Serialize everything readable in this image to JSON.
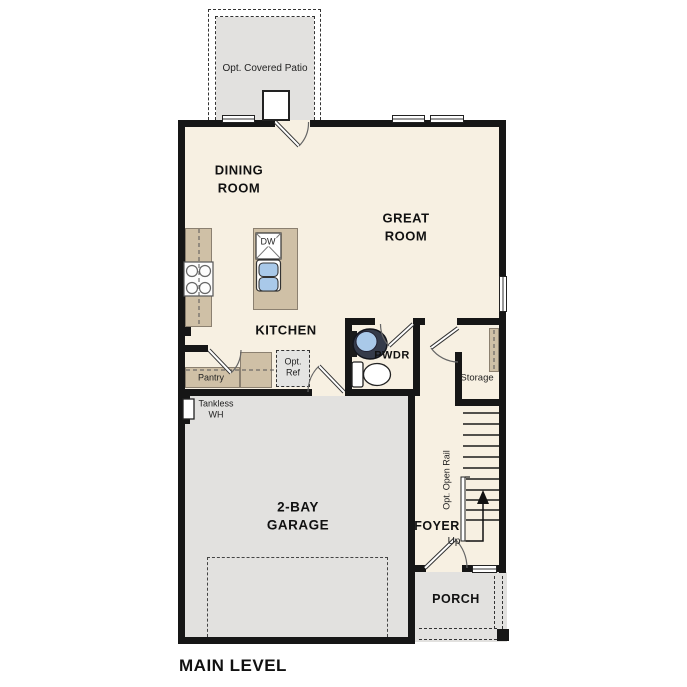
{
  "plan_title": "MAIN LEVEL",
  "labels": {
    "patio": "Opt. Covered Patio",
    "dining": [
      "DINING",
      "ROOM"
    ],
    "great": [
      "GREAT",
      "ROOM"
    ],
    "kitchen": "KITCHEN",
    "dishwasher": "DW",
    "powder": "PWDR",
    "pantry": "Pantry",
    "opt_ref": [
      "Opt.",
      "Ref"
    ],
    "storage": "Storage",
    "tankless": [
      "Tankless",
      "WH"
    ],
    "garage": [
      "2-BAY",
      "GARAGE"
    ],
    "open_rail": "Opt. Open Rail",
    "foyer": "FOYER",
    "up": "Up",
    "porch": "PORCH"
  },
  "colors": {
    "floor": "#f7f0e2",
    "optional_area": "#e2e1df",
    "counter": "#cfc0a6",
    "wall": "#161616",
    "sink": "#a9c9e9"
  }
}
